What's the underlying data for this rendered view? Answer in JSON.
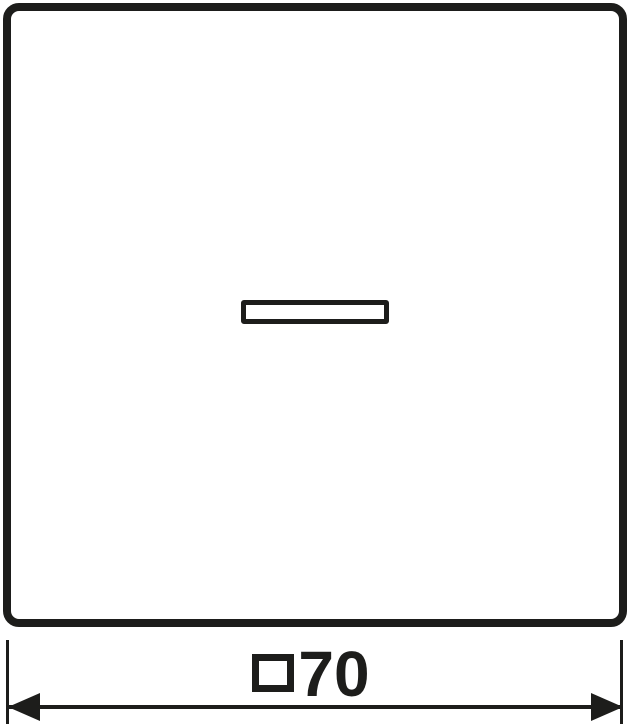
{
  "drawing": {
    "type": "technical-dimension-drawing",
    "part": "switch rocker with indicator window",
    "dimension": {
      "symbol": "□",
      "symbol_icon": "square-outline-icon",
      "value": "70",
      "full_label": "□70"
    },
    "icons": {
      "arrow_left": "filled-left-arrowhead",
      "arrow_right": "filled-right-arrowhead",
      "square_symbol": "white-square-outline"
    },
    "colors": {
      "line": "#1d1d1b",
      "background": "#ffffff"
    }
  }
}
